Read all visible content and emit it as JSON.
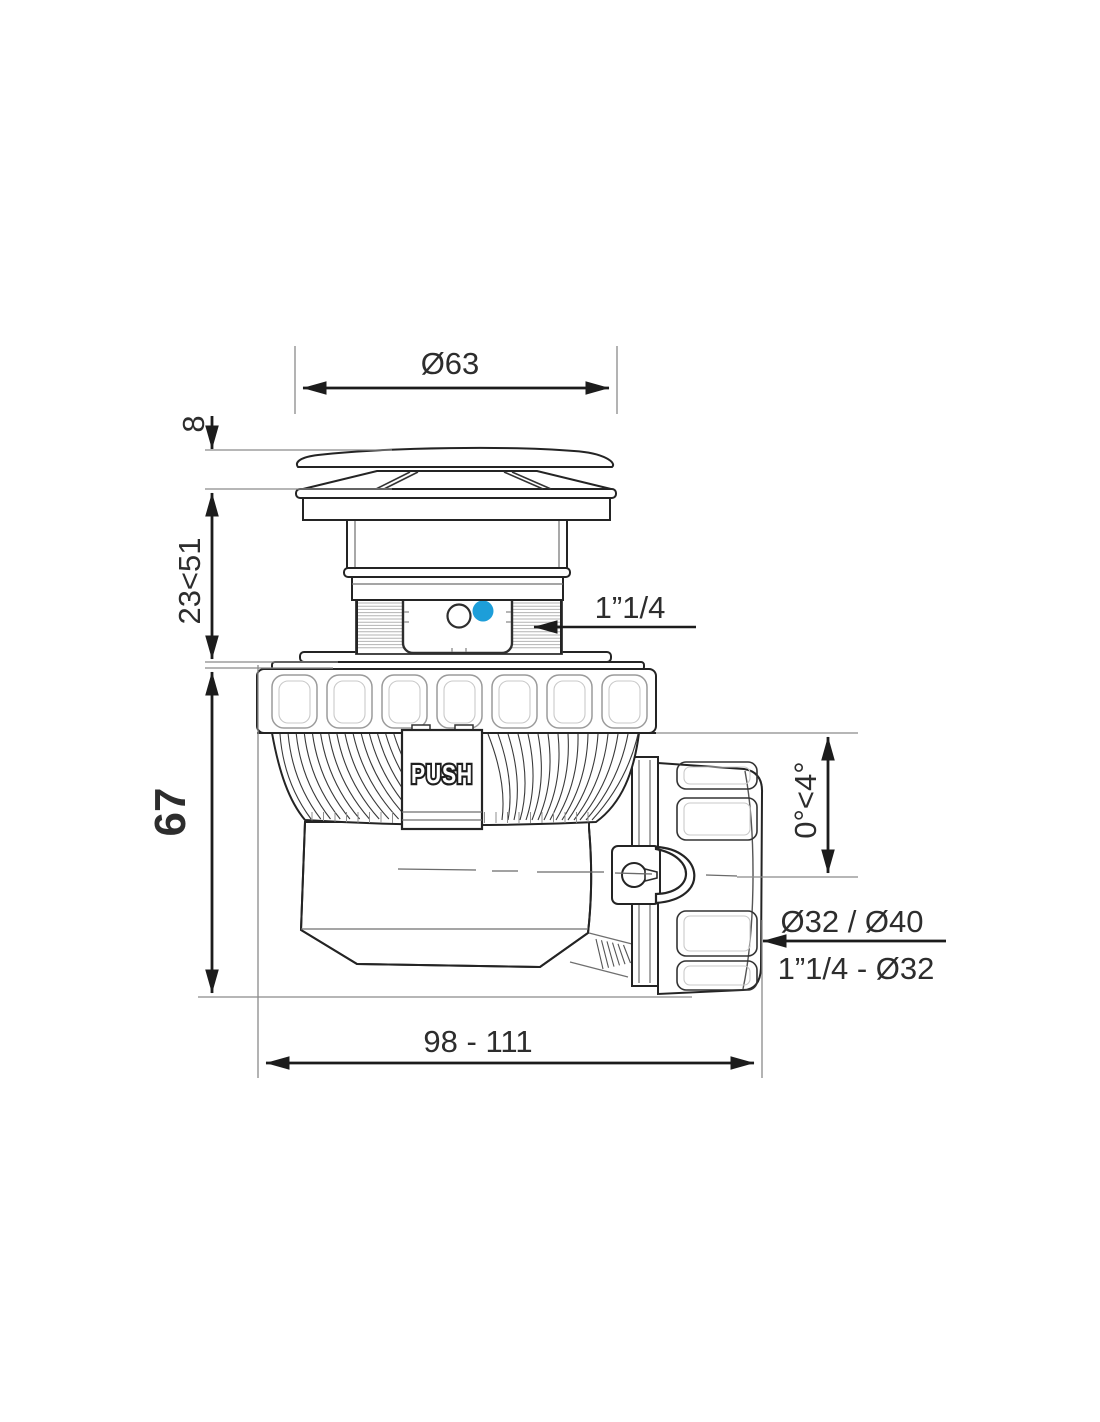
{
  "drawing": {
    "labels": {
      "cap_diameter": "Ø63",
      "cap_thickness": "8",
      "adjust_range": "23<51",
      "body_height": "67",
      "inlet_thread": "1”1/4",
      "push": "PUSH",
      "tilt_angle": "0°<4°",
      "outlet_diameters": "Ø32 / Ø40",
      "outlet_thread": "1”1/4 - Ø32",
      "overall_length": "98 - 111"
    },
    "colors": {
      "indicator_blue": "#1d9ed9",
      "line": "#242424"
    }
  }
}
